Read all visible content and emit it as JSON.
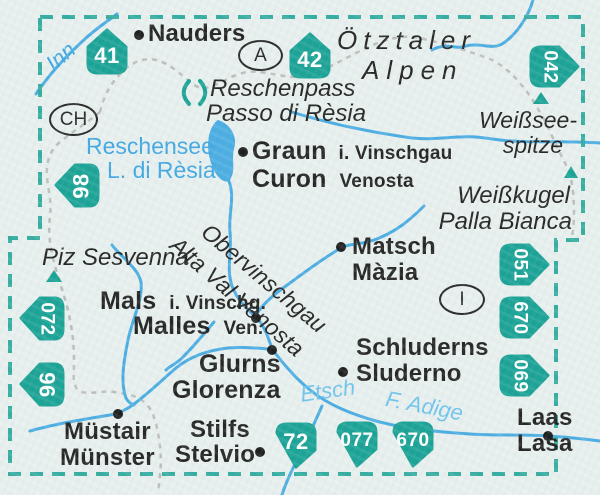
{
  "map": {
    "title_context": "Kompass map index – Reschenpass / Vinschgau area",
    "colors": {
      "badge_teal": "#14a093",
      "border_teal": "#2fab9e",
      "river_blue": "#46abe2",
      "water_label_blue": "#3aa5e2",
      "water_label_light": "#6cc2ec",
      "country_border_gray": "#b4b4b2",
      "text_black": "#1d1d1b",
      "background": "#e8f0ee"
    },
    "sheet_badges": {
      "b41": "41",
      "b42": "42",
      "b042": "042",
      "b98": "98",
      "b051": "051",
      "b670r": "670",
      "b069": "069",
      "b072": "072",
      "b96": "96",
      "b72": "72",
      "b077": "077",
      "b670b": "670"
    },
    "country_codes": {
      "austria": "A",
      "switzerland": "CH",
      "italy": "I"
    },
    "towns": {
      "nauders": "Nauders",
      "graun_de": "Graun",
      "graun_de_suffix": "i. Vinschgau",
      "graun_it": "Curon",
      "graun_it_suffix": "Venosta",
      "matsch_de": "Matsch",
      "matsch_it": "Màzia",
      "mals_de": "Mals",
      "mals_de_suffix": "i. Vinschg.",
      "mals_it": "Malles",
      "mals_it_suffix": "Ven.",
      "schluderns_de": "Schluderns",
      "schluderns_it": "Sluderno",
      "glurns_de": "Glurns",
      "glurns_it": "Glorenza",
      "muestair_rm": "Müstair",
      "muestair_de": "Münster",
      "stilfs_de": "Stilfs",
      "stilfs_it": "Stelvio",
      "laas_de": "Laas",
      "laas_it": "Lasa"
    },
    "mountains": {
      "oetztaler_line1": "Ötztaler",
      "oetztaler_line2": "Alpen",
      "weissseespitze_line1": "Weißsee-",
      "weissseespitze_line2": "spitze",
      "weisskugel_line1": "Weißkugel",
      "weisskugel_line2": "Palla Bianca",
      "piz_sesvenna": "Piz Sesvenna"
    },
    "passes": {
      "reschenpass_de": "Reschenpass",
      "reschenpass_it": "Passo di Rèsia"
    },
    "valleys": {
      "obervinschgau_de": "Obervinschgau",
      "obervinschgau_it": "Alta Val Venosta"
    },
    "water": {
      "inn": "Inn",
      "reschensee_de": "Reschensee",
      "reschensee_it": "L. di Rèsia",
      "etsch": "Etsch",
      "adige": "F. Adige"
    }
  }
}
